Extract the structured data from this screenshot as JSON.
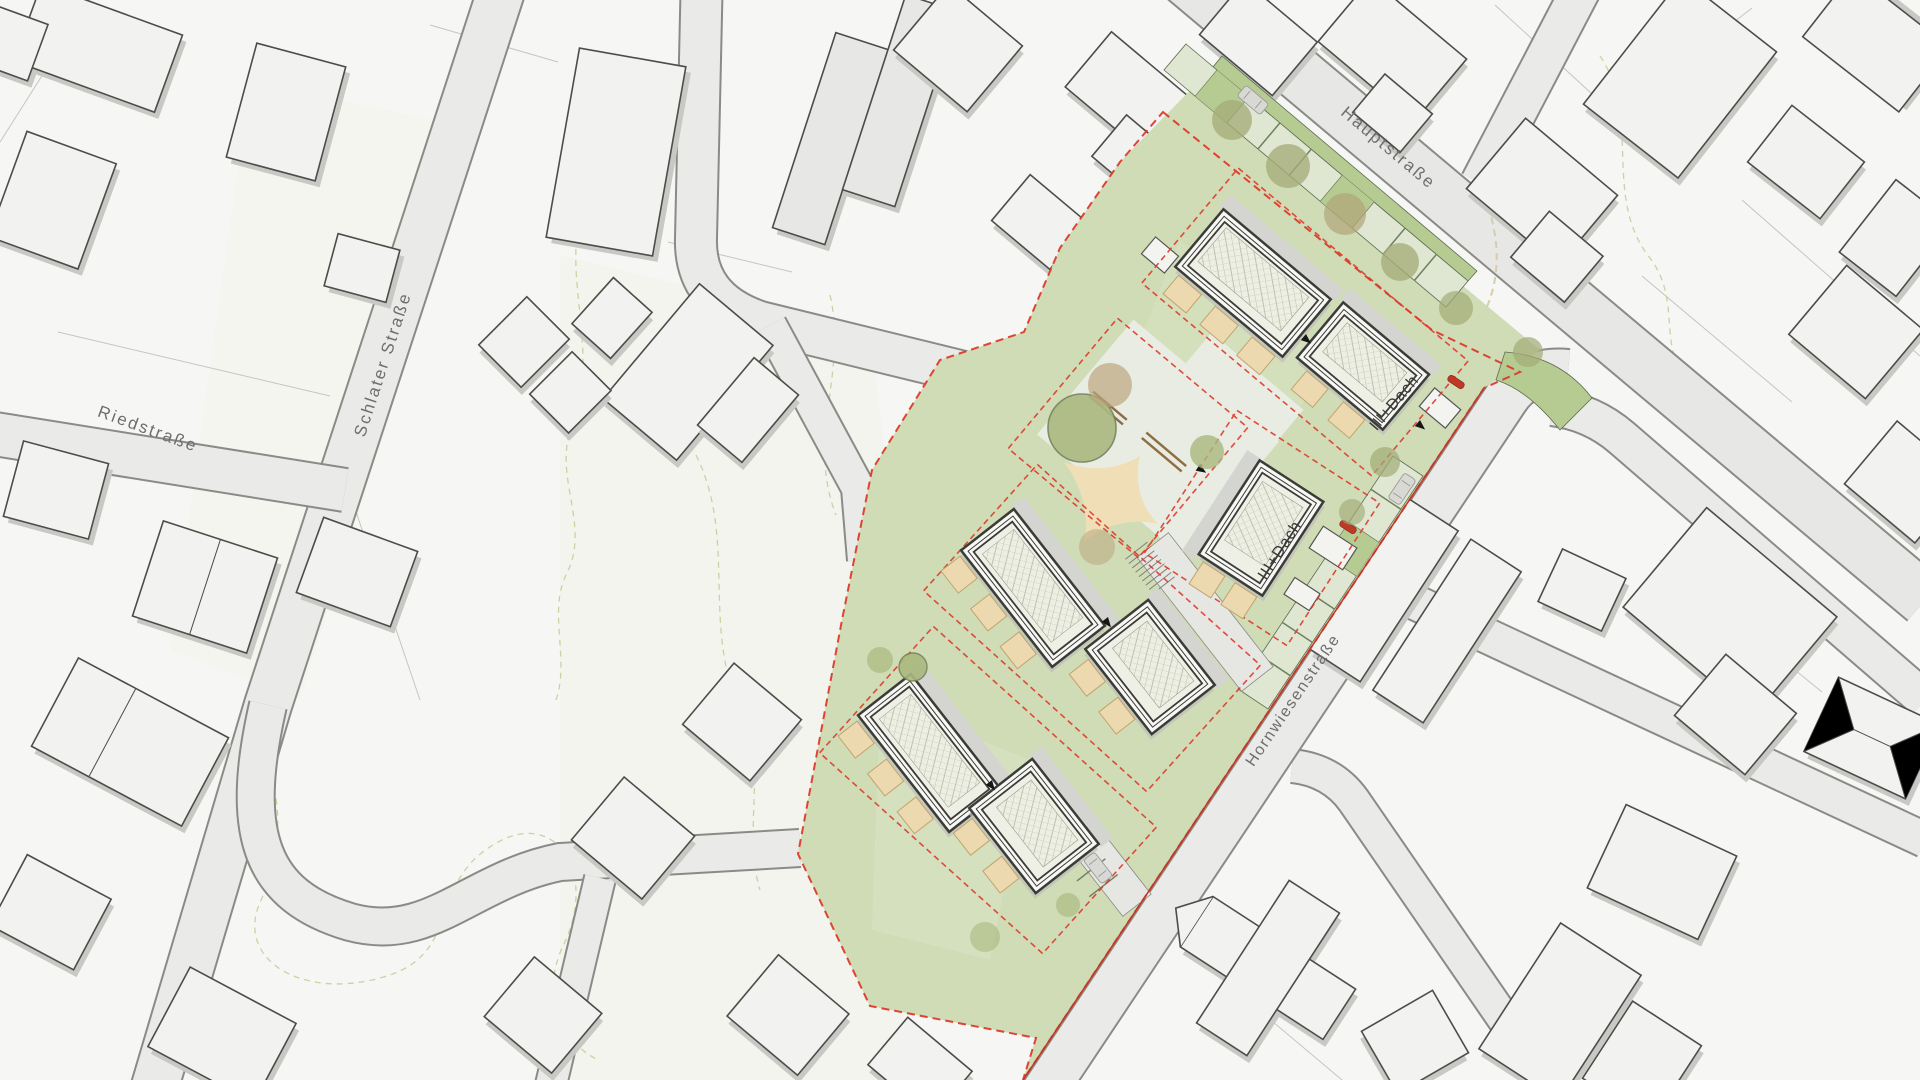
{
  "map": {
    "type": "architectural-site-plan",
    "street_labels": [
      {
        "id": "hauptstrasse",
        "name": "Hauptstraße"
      },
      {
        "id": "schlater-strasse",
        "name": "Schlater Straße"
      },
      {
        "id": "riedstrasse",
        "name": "Riedstraße"
      },
      {
        "id": "hornwiesenstrasse",
        "name": "Hornwiesenstraße"
      }
    ],
    "site": {
      "building_labels": [
        {
          "id": "building-northeast",
          "text": "III+Dach"
        },
        {
          "id": "building-middle",
          "text": "III+Dach"
        }
      ]
    },
    "colors": {
      "site_green": "#cfdcb5",
      "hedge_green": "#b6cb92",
      "boundary_red": "#dd3a2a",
      "roof": "#eef0e5",
      "terrace": "#ecd9b0",
      "tree": "#aab87f",
      "road_fill": "#eaeae8",
      "building_fill": "#f2f2f0",
      "shadow": "#c8c8c4"
    }
  }
}
